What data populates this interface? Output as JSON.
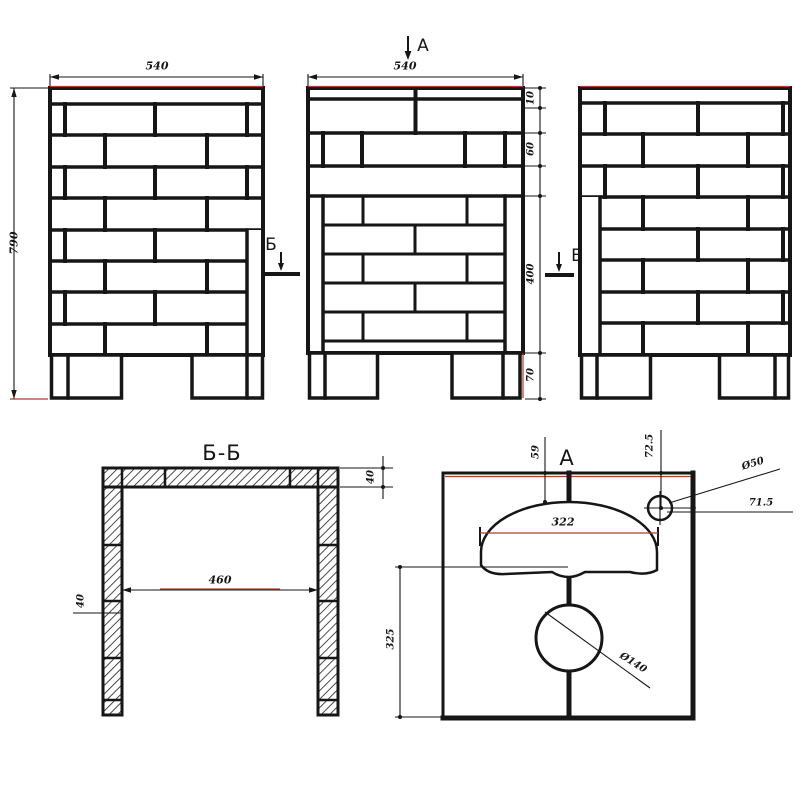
{
  "colors": {
    "ink": "#161616",
    "accent": "#b33a2e",
    "paper": "#ffffff"
  },
  "annotations": {
    "section_cut_label": "Б",
    "plan_cut_label": "A"
  },
  "left_view": {
    "dim_width": "540",
    "dim_height": "790"
  },
  "front_view": {
    "dim_width": "540",
    "dim_cap": "10",
    "dim_upper_course": "60",
    "dim_opening": "400",
    "dim_leg": "70"
  },
  "section_view": {
    "title": "Б-Б",
    "dim_slab_thickness": "40",
    "dim_inner_width": "460",
    "dim_wall_thickness": "40"
  },
  "plan_view": {
    "title": "A",
    "dim_arch_offset": "59",
    "dim_hole_offset_vertical": "72.5",
    "dim_hole_diameter": "Ø50",
    "dim_hole_offset_horizontal": "71.5",
    "dim_arch_width": "322",
    "dim_depth": "325",
    "dim_pipe_diameter": "Ø140"
  }
}
